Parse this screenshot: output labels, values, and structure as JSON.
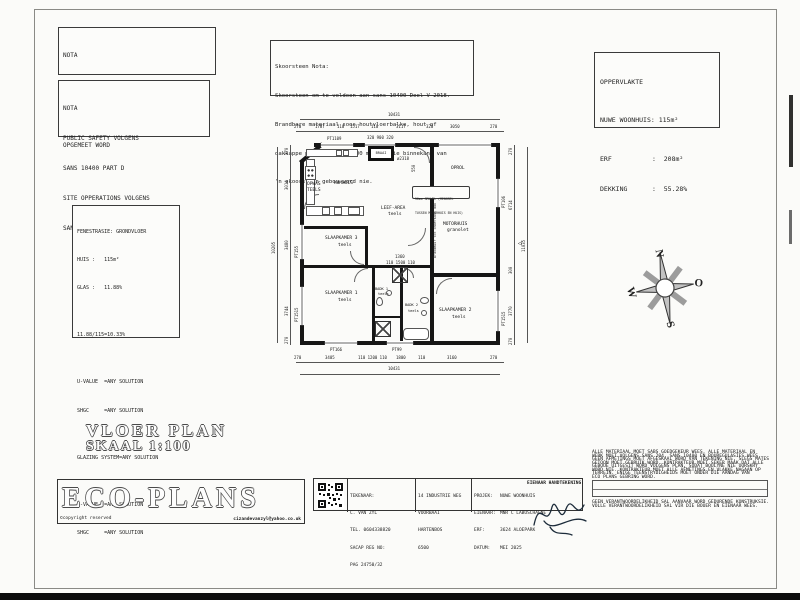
{
  "page_title": {
    "line1": "VLOER PLAN",
    "line2": "SKAAL 1:100"
  },
  "nota_deure": {
    "title": "NOTA",
    "lines": [
      "ALLE DEURE EN VENSTERS",
      "MOET DEUR DIE VERVAARDIGER",
      "OPGEMEET WORD"
    ]
  },
  "nota_safety": {
    "title": "NOTA",
    "lines": [
      "PUBLIC SAFETY VOLGENS",
      "SANS 10400 PART D",
      "SITE OPPERATIONS VOLGENS",
      "SANS 10400 PART F"
    ]
  },
  "skoorsteen_nota": {
    "title": "Skoorsteen Nota:",
    "lines": [
      "Skoorsteen om te voldoen aan sans 10400 Deel V 2018.",
      "Brandbare materiaal soos houtvloerbalke, hout of",
      "dakkappe mag nie binne 200 mm van die binnekant van",
      "'n skoorsteen gebou word nie."
    ]
  },
  "oppervlakte": {
    "title": "OPPERVLAKTE",
    "rows": [
      {
        "label": "NUWE WOONHUIS:",
        "value": "115m²"
      },
      {
        "label": "ERF",
        "value": ":  208m²"
      },
      {
        "label": "DEKKING",
        "value": ":  55.28%"
      }
    ]
  },
  "fenestrasie": {
    "lines": [
      "FENESTRASIE: GRONDVLOER",
      "HUIS :   115m²",
      "GLAS :   11.88%",
      "",
      "11.88/115=10.33%",
      "",
      "U-VALUE  =ANY SOLUTION",
      "SHGC     =ANY SOLUTION",
      "",
      "GLAZING SYSTEM=ANY SOLUTION",
      "",
      "U-VALUE  =ANY SOLUTION",
      "SHGC     =ANY SOLUTION"
    ]
  },
  "plan": {
    "rooms": {
      "kombuis": "KOMBUIS",
      "opwas1": "OPWAS",
      "opwas2": "TEELS",
      "braai": "BRAAI",
      "leef1": "LEEF-AREA",
      "leef2": "teels",
      "oprol": "OPROL",
      "motorhuis1": "MOTORHUIS",
      "motorhuis2": "granolet",
      "slaap3a": "SLAAPKAMER 3",
      "slaap3b": "teels",
      "slaap1a": "SLAAPKAMER 1",
      "slaap1b": "teels",
      "badk1a": "BADK 1",
      "badk1b": "teels",
      "badk2a": "BADK 2",
      "badk2b": "teels",
      "slaap2a": "SLAAPKAMER 2",
      "slaap2b": "teels"
    },
    "notes": {
      "brandmuur": "Brandmuur tot onderkant dak",
      "gravel1": "50mm GRUWEL (MENGSEL",
      "gravel2": "TUSSEN MOTORHUIS EN HUIS)"
    },
    "windows": {
      "top1": "PT1109",
      "bottom1": "PT166",
      "bottom2": "PT99",
      "left1": "PT155",
      "left2": "PT1515",
      "right1": "PT106",
      "right2": "PT1515"
    },
    "dims": {
      "top_total": "10431",
      "top": [
        "270",
        "1787",
        "110",
        "1517",
        "110",
        "3117",
        "320",
        "3050",
        "270"
      ],
      "top_sub": "320 900 320",
      "flue": "ø2318",
      "d550": "550",
      "mid1": "1360",
      "mid2": "110 1500 110",
      "bottom": [
        "270",
        "3405",
        "110 1200 110",
        "1800",
        "110",
        "3160",
        "270"
      ],
      "bottom_total": "10431",
      "left": [
        "270",
        "3014",
        "3480",
        "3744",
        "270"
      ],
      "left_total": "10205",
      "right": [
        "270",
        "6714",
        "300",
        "3770",
        "270"
      ],
      "right_total": "11035"
    }
  },
  "compass": {
    "n": "N",
    "e": "O",
    "s": "S",
    "w": "W"
  },
  "titleblock": {
    "brand": "ECO-PLANS",
    "copyright": "©copyright reserved",
    "email": "cizandevanzyl@yahoo.co.uk",
    "drafter": [
      "TEKENAAR:",
      "C. VAN ZYL",
      "TEL. 0604338820",
      "SACAP REG NO:",
      "PAG 24750/32"
    ],
    "address": [
      "14 INDUSTRIE WEG",
      "VOORBAAI",
      "HARTENBOS",
      "6500"
    ],
    "project": [
      [
        "PROJEK:",
        "NUWE WOONHUIS"
      ],
      [
        "EIENAAR:",
        "MNR C LABUSCHAGNE"
      ],
      [
        "ERF:",
        "3624 ALOEPARK"
      ],
      [
        "DATUM:",
        "MEI 2025"
      ]
    ],
    "signature_label": "EIENAAR HANDTEKENING:"
  },
  "legal": {
    "lines_top": [
      "ALLE MATERIAAL MOET SABS GOEDGEKEUR WEES. ALLE MATERIAAL EN",
      "WERK MOET VOLGENS SANS 204, SANS 10400 EN BOUREGULASIES WEES.",
      "GEEN AFMETINGS MOET AFGESKAAL WORD VAN TEKENING NIE, SLEGS MATES",
      "GETOON MOET GEBRUIK WORD. KONTRAKTEUR MOET SEKER MAAK DAT ALLE",
      "GEBOUE UITGESIT WORD VOLGENS PLAN, SODAT BOULYNE NIE OORSKRY",
      "WORD NIE. KONTRAKTEUR MOET ALLE AFMETINGS EN VLAKKE NAGAAN OP",
      "TERREIN. ENIGE TEENSTRYDIGHEIDS MOET ONDER DIE AANDAG VAN",
      "ECO PLANS GEBRING WORD."
    ],
    "lines_bottom": [
      "GEEN VERANTWOORDELIKHEID SAL AANVAAR WORD GEDURENDE KONSTRUKSIE.",
      "VOLLE VERANTWOORDELIKHEID SAL VIR DIE BOUER EN EIENAAR WEES."
    ]
  }
}
